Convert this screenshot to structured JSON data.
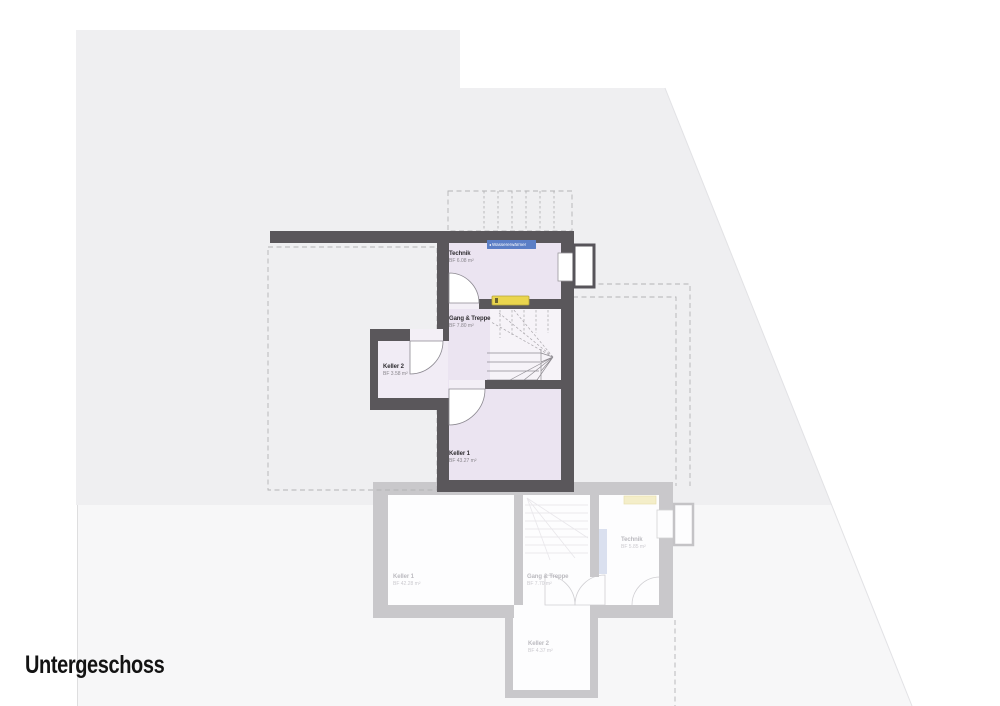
{
  "title": "Untergeschoss",
  "floor_plan": {
    "annotation_badge": {
      "marker": "◂",
      "label": "Wassererwärmer"
    },
    "rooms": [
      {
        "name": "Technik",
        "area": "BF 6.08 m²"
      },
      {
        "name": "Gang & Treppe",
        "area": "BF 7.80 m²"
      },
      {
        "name": "Keller 2",
        "area": "BF 3.58 m²"
      },
      {
        "name": "Keller 1",
        "area": "BF 43.27 m²"
      }
    ]
  },
  "ghost_plan": {
    "rooms": [
      {
        "name": "Keller 1",
        "area": "BF 42.28 m²"
      },
      {
        "name": "Gang & Treppe",
        "area": "BF 7.70 m²"
      },
      {
        "name": "Technik",
        "area": "BF 5.85 m²"
      },
      {
        "name": "Keller 2",
        "area": "BF 4.37 m²"
      }
    ]
  },
  "colors": {
    "wall_dark": "#5a575b",
    "room_fill": "#ebe4f1",
    "stair_fill": "#f6f3f8",
    "ghost_wall": "#c9c8cb",
    "site_fill": "#efeff1",
    "lower_site_fill": "#f7f7f8",
    "accent_yellow": "#ead54e",
    "badge_blue": "#5b7ec6"
  }
}
